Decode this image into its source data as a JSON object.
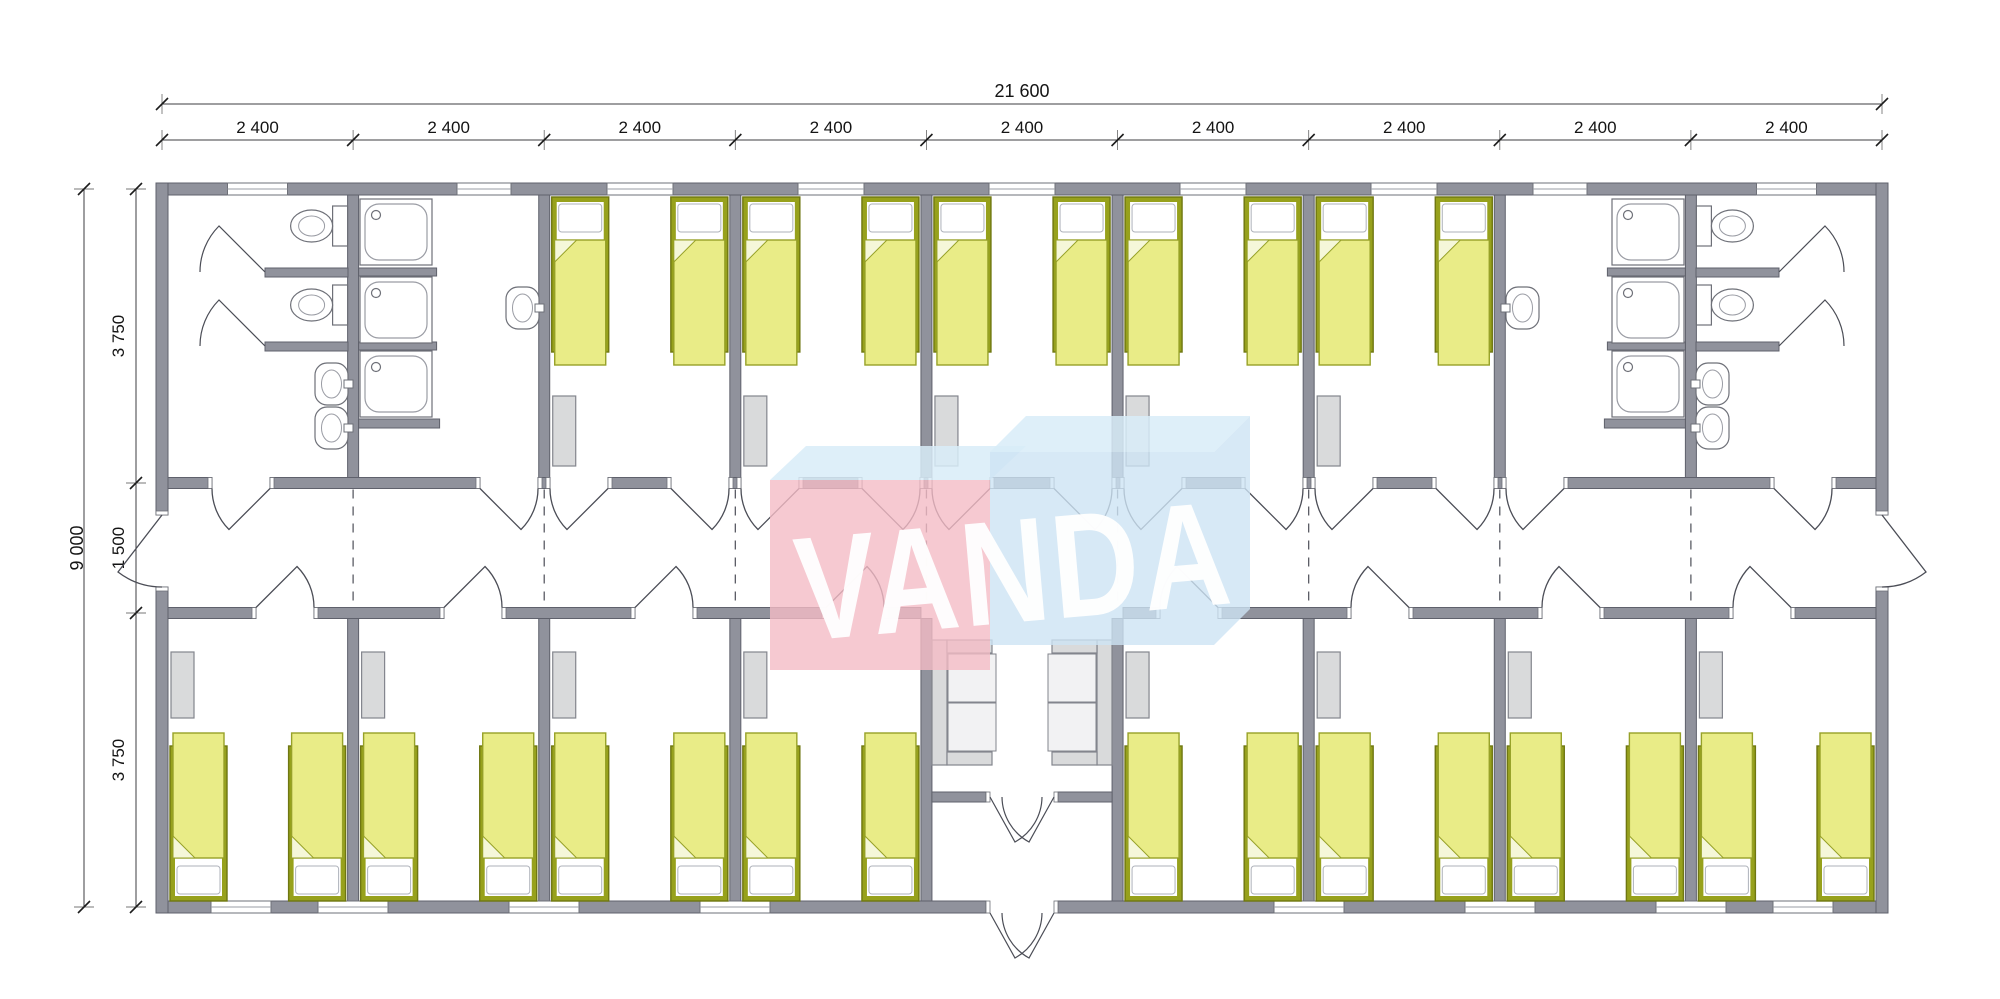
{
  "drawing": {
    "type": "floor-plan",
    "description": "modular dormitory building plan with central corridor",
    "watermark_text": "VANDA",
    "module_count": 9
  },
  "dimensions": {
    "top_total": "21 600",
    "module_label": "2 400",
    "left_total": "9 000",
    "left_segments": [
      "3 750",
      "1 500",
      "3 750"
    ]
  },
  "inventory": {
    "top_row": {
      "bathrooms": 2,
      "toilets_per_bathroom": 2,
      "showers_per_bathroom": 3,
      "washbasins_per_bathroom": 3,
      "bedrooms": 5,
      "beds": 10
    },
    "bottom_row": {
      "bedrooms": 8,
      "beds": 16,
      "wardrobes": 8
    },
    "lobby": {
      "sofas": 2,
      "entrance": "double-door"
    },
    "corridor": {
      "width_label": "1 500",
      "exit_doors": 2
    }
  },
  "colors": {
    "wall": "#90929c",
    "wall_stroke": "#5f616c",
    "jamb": "#ffffff",
    "bed_frame": "#97a11c",
    "bed_frame_stroke": "#6f7711",
    "bed_fill": "#e9ec87",
    "bed_stroke": "#97a128",
    "fold_fill": "#f5f7d9",
    "pillow": "#ffffff",
    "pillow_stroke": "#aeb2ba",
    "furniture": "#d9dadb",
    "furniture_stroke": "#83858d",
    "fixture_stroke": "#6e7078",
    "fixture_inner": "#9a9ca4",
    "door_line": "#4b4d56",
    "axis_dash": "#5a5c64",
    "dim_line": "#3c3c40",
    "tick": "#1c1c1c",
    "wm_pink": "#f4bcc6",
    "wm_blue": "#cde4f4",
    "wm_blue_light": "#d8ecf8",
    "wm_text": "#ffffff"
  }
}
